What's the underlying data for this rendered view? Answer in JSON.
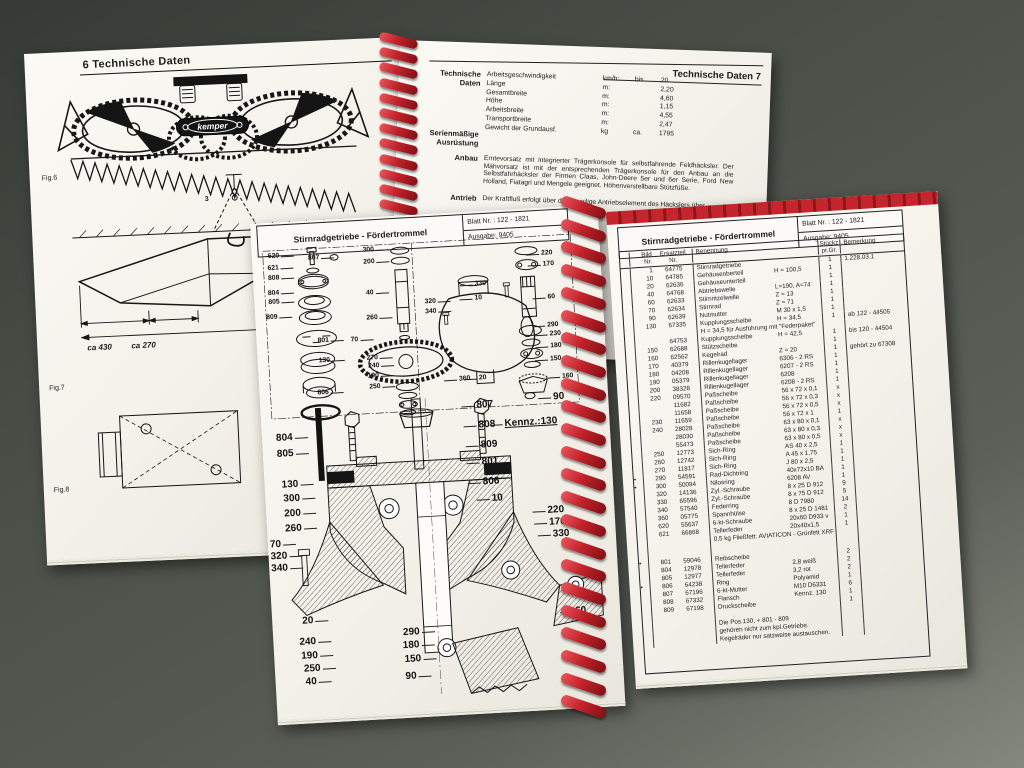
{
  "background_page_left": {
    "page_header": "6  Technische Daten",
    "brand": "kemper",
    "fig6_caption": "Fig.6",
    "fig7_caption": "Fig.7",
    "fig8_caption": "Fig.8",
    "hoist_label": "3",
    "dim_note_1": "ca 430",
    "dim_note_2": "ca 270",
    "dimensions": [
      {
        "code": "CL",
        "value": "= 2330"
      },
      {
        "code": "JD5",
        "value": "= 2250"
      },
      {
        "code": "JD6",
        "value": "= 2250"
      },
      {
        "code": "FA",
        "value": "= 2200"
      },
      {
        "code": "ME",
        "value": "= 2240"
      },
      {
        "code": "HE",
        "value": "= 2250"
      }
    ]
  },
  "background_page_right": {
    "page_header": "Technische Daten  7",
    "tech_label": "Technische\nDaten",
    "serien_label": "Serienmäßige\nAusrüstung",
    "anbau_label": "Anbau",
    "antrieb_label": "Antrieb",
    "specs": [
      {
        "name": "Arbeitsgeschwindigkeit",
        "unit": "km/h:",
        "qual": "bis",
        "value": "20"
      },
      {
        "name": "Länge",
        "unit": "m:",
        "qual": "",
        "value": "2,20"
      },
      {
        "name": "Gesamtbreite",
        "unit": "m:",
        "qual": "",
        "value": "4,60"
      },
      {
        "name": "Höhe",
        "unit": "m:",
        "qual": "",
        "value": "1,15"
      },
      {
        "name": "Arbeitsbreite",
        "unit": "m:",
        "qual": "",
        "value": "4,55"
      },
      {
        "name": "Transportbreite",
        "unit": "m:",
        "qual": "",
        "value": "2,47"
      },
      {
        "name": "Gewicht der Grundausf.",
        "unit": "kg",
        "qual": "ca.",
        "value": "1795"
      }
    ],
    "anbau_text": "Erntevorsatz mit integrierter Trägerkonsole für selbstfahrende Feldhäcksler. Der Mähvorsatz ist mit der entsprechenden Trägerkonsole für den Anbau an die Selbstfahrhäcksler der Firmen Claas, John-Deere 5er und 6er Serie, Ford New Holland, Fiatagri und Mengele geeignet. Höhenverstellbare Stützfüße.",
    "antrieb_text": "Der Kraftfluß erfolgt über das jeweilige Antriebselement des Häckslers über"
  },
  "booklet": {
    "title": "Stirnradgetriebe - Fördertrommel",
    "blatt_nr": "Blatt Nr. : 122 - 1821",
    "ausgabe": "Ausgabe:  9405",
    "table": {
      "headers": {
        "bild": "Bild\nNr.",
        "teil": "Ersatzteil\nNr.",
        "benennung": "Benennung",
        "stueck": "Stückz\npr.Gr.",
        "bemerkung": "Bemerkung"
      },
      "rows": [
        {
          "b": "1",
          "t": "64775",
          "n": "Stirnradgetriebe",
          "s": "",
          "q": "1",
          "r": "1.228.03.1"
        },
        {
          "b": "10",
          "t": "64785",
          "n": "Gehäuseoberteil",
          "s": "H = 100,5",
          "q": "1",
          "r": ""
        },
        {
          "b": "20",
          "t": "62636",
          "n": "Gehäuseunterteil",
          "s": "",
          "q": "1",
          "r": ""
        },
        {
          "b": "40",
          "t": "64768",
          "n": "Abtriebswelle",
          "s": "L=190, A=74",
          "q": "1",
          "r": ""
        },
        {
          "b": "60",
          "t": "62633",
          "n": "Stirnritzelwelle",
          "s": "Z = 13",
          "q": "1",
          "r": ""
        },
        {
          "b": "70",
          "t": "62634",
          "n": "Stirnrad",
          "s": "Z = 71",
          "q": "1",
          "r": ""
        },
        {
          "b": "90",
          "t": "62639",
          "n": "Nutmutter",
          "s": "M 30 x 1,5",
          "q": "1",
          "r": ""
        },
        {
          "b": "130",
          "t": "67335",
          "n": "Kupplungsscheibe",
          "s": "H = 34,5",
          "q": "1",
          "r": "ab 122 - 44505"
        },
        {
          "n": "H = 34,5 für Ausführung mit \"Federpaket\"",
          "wide": true
        },
        {
          "t": "64753",
          "n": "Kupplungsscheibe",
          "s": "H = 42,5",
          "q": "1",
          "r": "bis 120 - 44504"
        },
        {
          "b": "150",
          "t": "62688",
          "n": "Stützscheibe",
          "s": "",
          "q": "1",
          "r": ""
        },
        {
          "b": "160",
          "t": "62562",
          "n": "Kegelrad",
          "s": "Z = 20",
          "q": "1",
          "r": "gehört zu 67308"
        },
        {
          "b": "170",
          "t": "40379",
          "n": "Rillenkugellager",
          "s": "6306 - 2 RS",
          "q": "1",
          "r": ""
        },
        {
          "b": "180",
          "t": "04208",
          "n": "Rillenkugellager",
          "s": "6207 - 2 RS",
          "q": "1",
          "r": ""
        },
        {
          "b": "190",
          "t": "05379",
          "n": "Rillenkugellager",
          "s": "6208",
          "q": "1",
          "r": ""
        },
        {
          "b": "200",
          "t": "38328",
          "n": "Rillenkugellager",
          "s": "6208 - 2 RS",
          "q": "1",
          "r": ""
        },
        {
          "b": "220",
          "t": "09570",
          "n": "Paßscheibe",
          "s": "56 x 72 x 0,1",
          "q": "x",
          "r": ""
        },
        {
          "t": "11682",
          "n": "Paßscheibe",
          "s": "56 x 72 x 0,3",
          "q": "x",
          "r": ""
        },
        {
          "t": "11658",
          "n": "Paßscheibe",
          "s": "56 x 72 x 0,5",
          "q": "x",
          "r": ""
        },
        {
          "b": "230",
          "t": "11659",
          "n": "Paßscheibe",
          "s": "56 x 72 x 1",
          "q": "1",
          "r": ""
        },
        {
          "b": "240",
          "t": "28028",
          "n": "Paßscheibe",
          "s": "63 x 80 x 0,1",
          "q": "x",
          "r": ""
        },
        {
          "t": "28030",
          "n": "Paßscheibe",
          "s": "63 x 80 x 0,3",
          "q": "x",
          "r": ""
        },
        {
          "t": "55473",
          "n": "Paßscheibe",
          "s": "63 x 80 x 0,5",
          "q": "x",
          "r": ""
        },
        {
          "b": "250",
          "t": "12773",
          "n": "Sich-Ring",
          "s": "AS 40 x 2,5",
          "q": "1",
          "r": ""
        },
        {
          "b": "260",
          "t": "12742",
          "n": "Sich-Ring",
          "s": "A  45 x 1,75",
          "q": "1",
          "r": ""
        },
        {
          "b": "270",
          "t": "11817",
          "n": "Sich-Ring",
          "s": "J  80 x 2,5",
          "q": "1",
          "r": ""
        },
        {
          "m": "•",
          "b": "290",
          "t": "54591",
          "n": "Rad-Dichtring",
          "s": "40x72x10 BA",
          "q": "1",
          "r": ""
        },
        {
          "m": "•",
          "b": "300",
          "t": "50094",
          "n": "Nilosring",
          "s": "6208 AV",
          "q": "1",
          "r": ""
        },
        {
          "b": "320",
          "t": "14136",
          "n": "Zyl.-Schraube",
          "s": "8 x 25  D 912",
          "q": "9",
          "r": ""
        },
        {
          "b": "330",
          "t": "65596",
          "n": "Zyl.-Schraube",
          "s": "8 x 75  D 912",
          "q": "5",
          "r": ""
        },
        {
          "b": "340",
          "t": "57540",
          "n": "Federring",
          "s": "8          D 7980",
          "q": "14",
          "r": ""
        },
        {
          "b": "360",
          "t": "05775",
          "n": "Spannhülse",
          "s": "8 x 25  D 1481",
          "q": "2",
          "r": ""
        },
        {
          "b": "620",
          "t": "55637",
          "n": "6-kt-Schraube",
          "s": "20x60 D933 v",
          "q": "1",
          "r": ""
        },
        {
          "b": "621",
          "t": "66868",
          "n": "Tellerfeder",
          "s": "20x40x1,5",
          "q": "1",
          "r": ""
        },
        {
          "n": "0,5 kg Fließfett:    AVIATICON -  Grünfett  XRF",
          "wide": true
        },
        {
          "gap": 12
        },
        {
          "m": "•",
          "b": "801",
          "t": "59046",
          "n": "Reibscheibe",
          "s": "",
          "q": "2",
          "r": ""
        },
        {
          "b": "804",
          "t": "12978",
          "n": "Tellerfeder",
          "s": "2,8 weiß",
          "q": "2",
          "r": ""
        },
        {
          "b": "805",
          "t": "12977",
          "n": "Tellerfeder",
          "s": "3,2 rot",
          "q": "2",
          "r": ""
        },
        {
          "m": "•",
          "b": "806",
          "t": "64238",
          "n": "Ring",
          "s": "Polyamid",
          "q": "1",
          "r": ""
        },
        {
          "b": "807",
          "t": "67196",
          "n": "6-kt-Mutter",
          "s": "M10 D6331",
          "q": "6",
          "r": ""
        },
        {
          "b": "808",
          "t": "67332",
          "n": "Flansch",
          "s": "Kennz. 130",
          "q": "1",
          "r": ""
        },
        {
          "b": "809",
          "t": "67198",
          "n": "Druckscheibe",
          "s": "",
          "q": "1",
          "r": ""
        },
        {
          "gap": 8
        },
        {
          "n": "Die Pos.130, + 801 - 809",
          "wide": true
        },
        {
          "n": "gehören nicht zum kpl.Getriebe.",
          "wide": true
        },
        {
          "n": "Kegelräder nur satzweise austauschen.",
          "wide": true
        }
      ]
    },
    "upper_diagram_labels": [
      {
        "t": "620",
        "x": 16,
        "y": 30
      },
      {
        "t": "807",
        "x": 56,
        "y": 34
      },
      {
        "t": "621",
        "x": 15,
        "y": 42
      },
      {
        "t": "808",
        "x": 15,
        "y": 52
      },
      {
        "t": "804",
        "x": 14,
        "y": 67
      },
      {
        "t": "805",
        "x": 14,
        "y": 76
      },
      {
        "t": "809",
        "x": 11,
        "y": 91
      },
      {
        "t": "801",
        "x": 61,
        "y": 117
      },
      {
        "t": "130",
        "x": 61,
        "y": 137
      },
      {
        "t": "806",
        "x": 58,
        "y": 169
      },
      {
        "t": "300",
        "x": 111,
        "y": 29
      },
      {
        "t": "200",
        "x": 111,
        "y": 41
      },
      {
        "t": "40",
        "x": 112,
        "y": 72
      },
      {
        "t": "260",
        "x": 111,
        "y": 97
      },
      {
        "t": "70",
        "x": 94,
        "y": 118
      },
      {
        "t": "270",
        "x": 109,
        "y": 137
      },
      {
        "t": "240",
        "x": 110,
        "y": 145
      },
      {
        "t": "190",
        "x": 109,
        "y": 155
      },
      {
        "t": "250",
        "x": 110,
        "y": 166
      },
      {
        "t": "320",
        "x": 170,
        "y": 84
      },
      {
        "t": "340",
        "x": 170,
        "y": 94
      },
      {
        "t": "330",
        "x": 221,
        "y": 69
      },
      {
        "t": "10",
        "x": 220,
        "y": 83
      },
      {
        "t": "360",
        "x": 200,
        "y": 163
      },
      {
        "t": "20",
        "x": 220,
        "y": 163
      },
      {
        "t": "220",
        "x": 289,
        "y": 42
      },
      {
        "t": "170",
        "x": 290,
        "y": 53
      },
      {
        "t": "60",
        "x": 293,
        "y": 86
      },
      {
        "t": "290",
        "x": 291,
        "y": 114
      },
      {
        "t": "230",
        "x": 293,
        "y": 123
      },
      {
        "t": "180",
        "x": 293,
        "y": 135
      },
      {
        "t": "150",
        "x": 292,
        "y": 148
      },
      {
        "t": "160",
        "x": 303,
        "y": 166
      }
    ],
    "lower_diagram_labels": [
      {
        "t": "90",
        "x": 293,
        "y": 184
      },
      {
        "t": "807",
        "x": 216,
        "y": 188
      },
      {
        "t": "808",
        "x": 217,
        "y": 208
      },
      {
        "t": "Kennz.:130",
        "x": 243,
        "y": 208,
        "k": true
      },
      {
        "t": "809",
        "x": 218,
        "y": 228
      },
      {
        "t": "801",
        "x": 218,
        "y": 245
      },
      {
        "t": "806",
        "x": 218,
        "y": 265
      },
      {
        "t": "10",
        "x": 226,
        "y": 282
      },
      {
        "t": "220",
        "x": 281,
        "y": 297
      },
      {
        "t": "170",
        "x": 282,
        "y": 309
      },
      {
        "t": "330",
        "x": 285,
        "y": 321
      },
      {
        "t": "804",
        "x": 14,
        "y": 210
      },
      {
        "t": "805",
        "x": 14,
        "y": 226
      },
      {
        "t": "130",
        "x": 17,
        "y": 257
      },
      {
        "t": "300",
        "x": 18,
        "y": 271
      },
      {
        "t": "200",
        "x": 18,
        "y": 286
      },
      {
        "t": "260",
        "x": 18,
        "y": 301
      },
      {
        "t": "70",
        "x": 2,
        "y": 316
      },
      {
        "t": "320",
        "x": 2,
        "y": 328
      },
      {
        "t": "340",
        "x": 2,
        "y": 340
      },
      {
        "t": "20",
        "x": 30,
        "y": 394
      },
      {
        "t": "240",
        "x": 26,
        "y": 415
      },
      {
        "t": "190",
        "x": 27,
        "y": 429
      },
      {
        "t": "250",
        "x": 29,
        "y": 442
      },
      {
        "t": "40",
        "x": 30,
        "y": 455
      },
      {
        "t": "290",
        "x": 130,
        "y": 411
      },
      {
        "t": "180",
        "x": 129,
        "y": 424
      },
      {
        "t": "150",
        "x": 130,
        "y": 438
      },
      {
        "t": "90",
        "x": 130,
        "y": 455
      },
      {
        "t": "60",
        "x": 303,
        "y": 399
      }
    ]
  },
  "colors": {
    "spiral_red": "#c3232b",
    "paper": "#f7f5f0",
    "backdrop": "#4a4f47"
  }
}
